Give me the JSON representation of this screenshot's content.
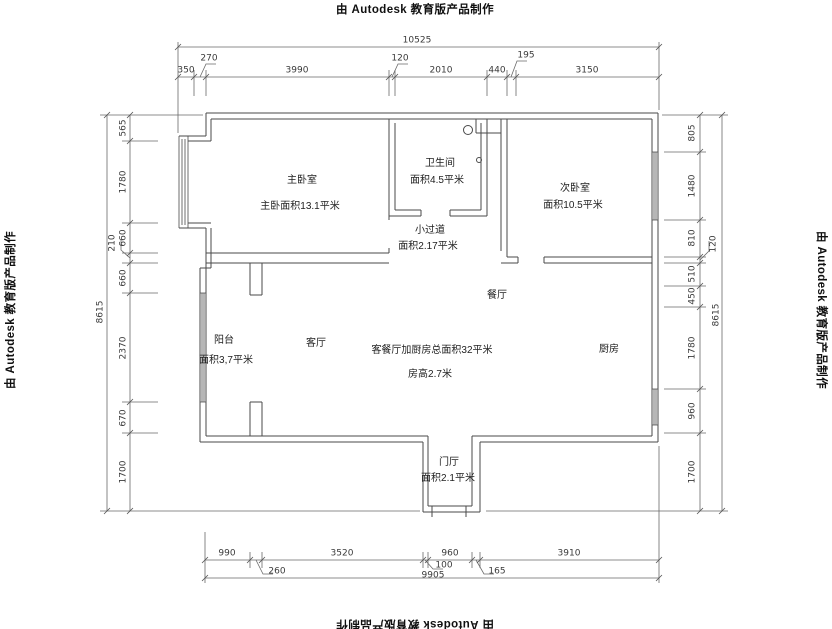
{
  "watermark": {
    "text": "由 Autodesk 教育版产品制作"
  },
  "rooms": {
    "master": {
      "name": "主卧室",
      "area": "主卧面积13.1平米"
    },
    "bathroom": {
      "name": "卫生间",
      "area": "面积4.5平米"
    },
    "second_bedroom": {
      "name": "次卧室",
      "area": "面积10.5平米"
    },
    "corridor": {
      "name": "小过道",
      "area": "面积2.17平米"
    },
    "dining": {
      "name": "餐厅"
    },
    "living": {
      "name": "客厅"
    },
    "balcony": {
      "name": "阳台",
      "area": "面积3,7平米"
    },
    "kitchen": {
      "name": "厨房"
    },
    "entry": {
      "name": "门厅",
      "area": "面积2.1平米"
    },
    "summary": {
      "line1": "客餐厅加厨房总面积32平米",
      "line2": "房高2.7米"
    }
  },
  "dimensions": {
    "top": {
      "overall": "10525",
      "segments": [
        "350",
        "270",
        "3990",
        "120",
        "2010",
        "440",
        "195",
        "3150"
      ]
    },
    "bottom": {
      "overall": "9905",
      "segments": [
        "990",
        "260",
        "3520",
        "100",
        "960",
        "165",
        "3910"
      ]
    },
    "left": {
      "overall": "8615",
      "segments": [
        "565",
        "1780",
        "660",
        "210",
        "660",
        "2370",
        "670",
        "1700"
      ]
    },
    "right": {
      "overall": "8615",
      "segments": [
        "805",
        "1480",
        "810",
        "120",
        "510",
        "450",
        "1780",
        "960",
        "1700"
      ]
    }
  },
  "colors": {
    "line": "#4a4a4a",
    "dim_line": "#6a6a6a",
    "text": "#222222"
  }
}
